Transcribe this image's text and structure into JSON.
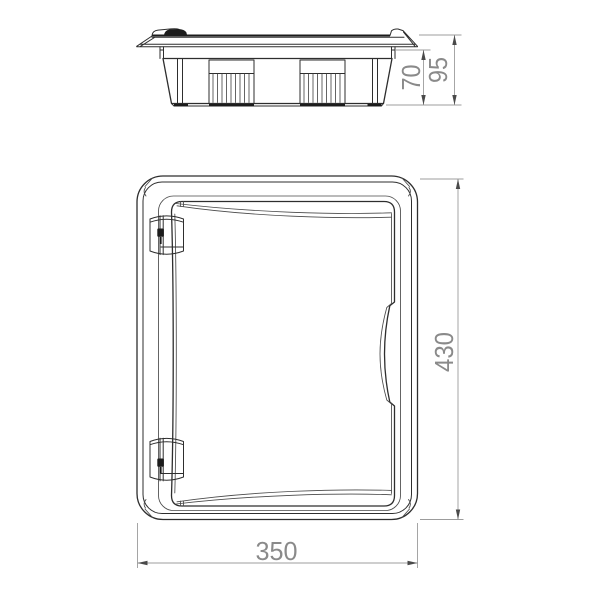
{
  "drawing": {
    "kind": "enclosure-technical-drawing",
    "dimensions": {
      "box_depth": "70",
      "total_depth": "95",
      "front_width": "350",
      "front_height": "430"
    }
  },
  "colors": {
    "background": "#ffffff",
    "line": "#2e2e2e",
    "line_light": "#4a4a4a",
    "dark_fill": "#1c1c1c",
    "dim_line": "#9c9c9c",
    "dim_text": "#8a8a8a",
    "arrow": "#4a4a4a"
  }
}
